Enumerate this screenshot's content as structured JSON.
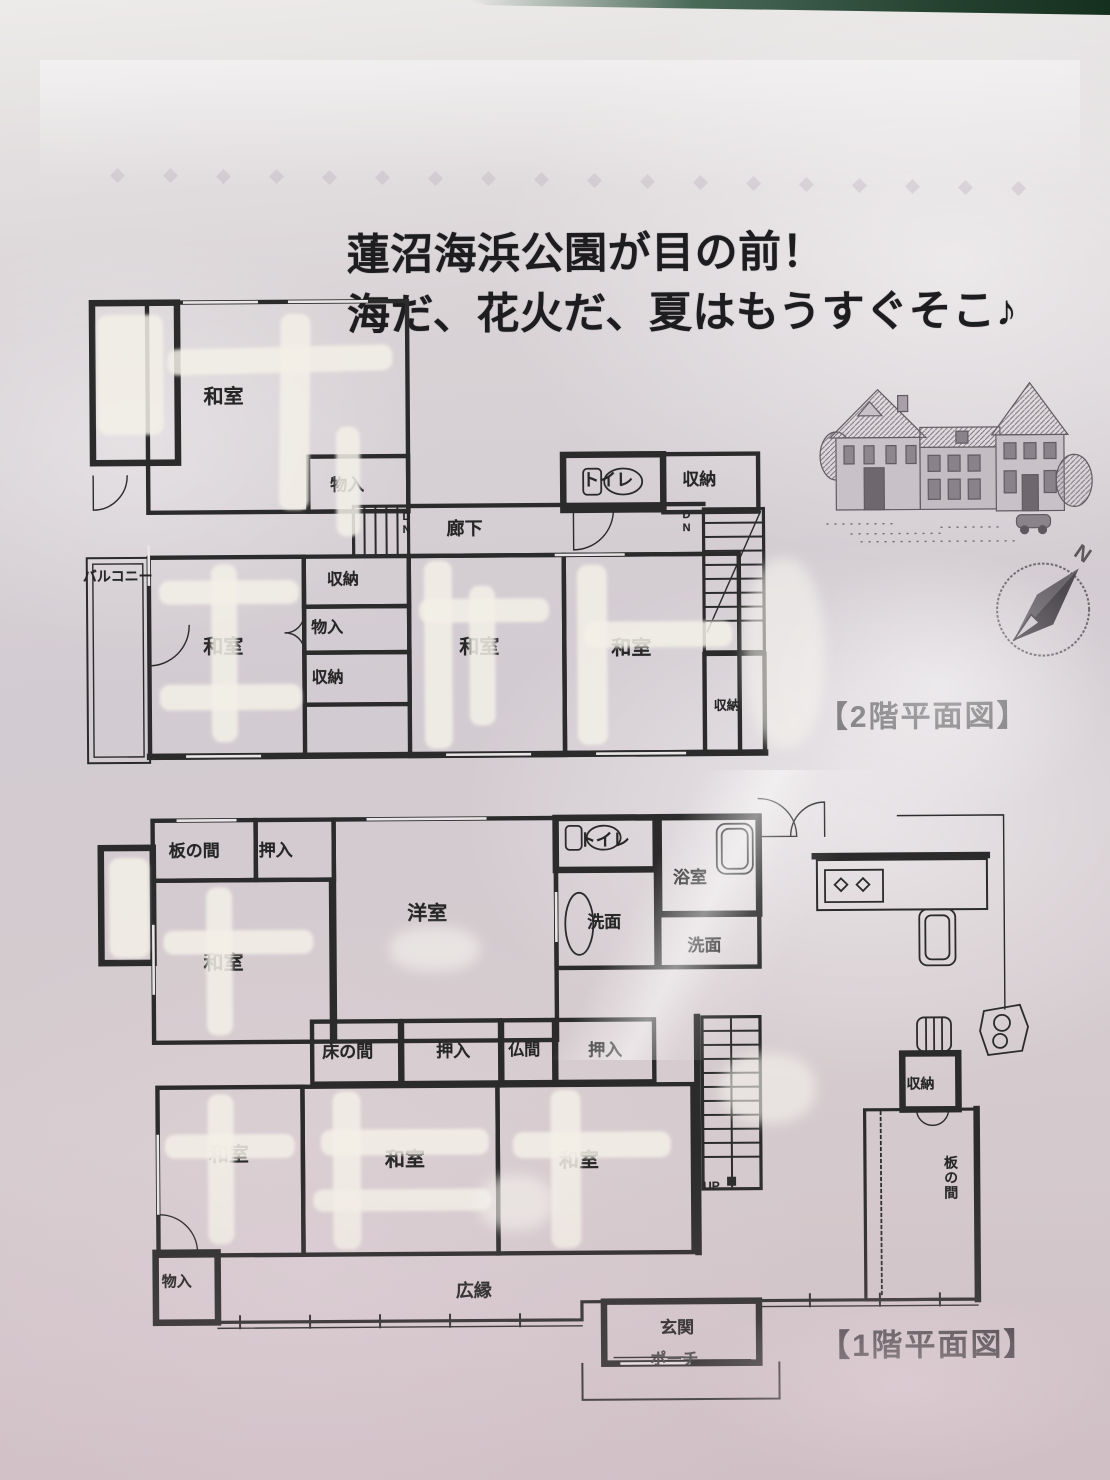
{
  "headline": {
    "line1": "蓮沼海浜公園が目の前！",
    "line2": "海だ、花火だ、夏はもうすぐそこ♪"
  },
  "floor2": {
    "title": "【2階平面図】",
    "labels": {
      "washitsu_top": "和室",
      "monoire_top": "物入",
      "dn_left": "DN",
      "rouka": "廊下",
      "toilet": "トイレ",
      "shunou_top_right": "収納",
      "dn_right": "DN",
      "balcony": "バルコニー",
      "washitsu_left": "和室",
      "shunou_center": "収納",
      "monoire_center": "物入",
      "shunou_center2": "収納",
      "washitsu_center": "和室",
      "washitsu_right": "和室",
      "shunou_right": "収納"
    }
  },
  "floor1": {
    "title": "【1階平面図】",
    "labels": {
      "itanoma_nw": "板の間",
      "oshiire_top": "押入",
      "washitsu_nw": "和室",
      "youshitsu": "洋室",
      "toilet": "トイレ",
      "senmen_1": "洗面",
      "yokushitsu": "浴室",
      "senmen_2": "洗面",
      "tokonoma": "床の間",
      "oshiire_mid_left": "押入",
      "butsuma": "仏間",
      "oshiire_mid_right": "押入",
      "washitsu_sw": "和室",
      "washitsu_s": "和室",
      "washitsu_se": "和室",
      "monoire_sw": "物入",
      "hiroen": "広縁",
      "genkan": "玄関",
      "porch": "ポーチ",
      "shunou_e": "収納",
      "itanoma_e": "板の間",
      "up": "UP"
    }
  },
  "compass": {
    "north": "N"
  },
  "colors": {
    "paper": "#d5cdd2",
    "plan_line": "#2b2b2b",
    "whiteout": "#f3f0e9",
    "green_edge": "#24402f",
    "headline_text": "#1d1d1f"
  }
}
